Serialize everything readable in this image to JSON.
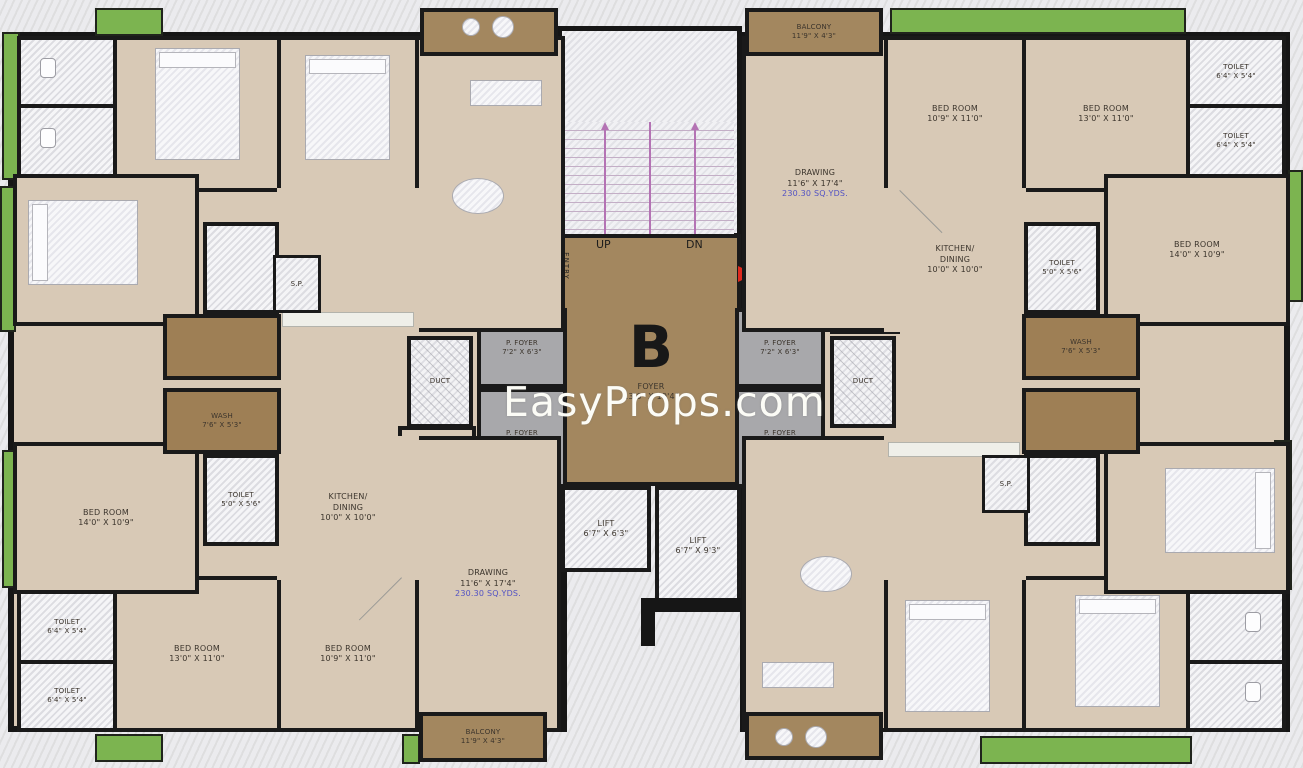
{
  "watermark": "EasyProps.com",
  "core": {
    "unit_letter": "B",
    "foyer": {
      "name": "FOYER",
      "dims": "13'6\" X 19'4\""
    },
    "up": "UP",
    "dn": "DN",
    "lift_left": {
      "name": "LIFT",
      "dims": "6'7\" X 6'3\""
    },
    "lift_right": {
      "name": "LIFT",
      "dims": "6'7\" X 9'3\""
    },
    "entries": {
      "e01": {
        "label": "ENTRY",
        "number": "01"
      },
      "e02": {
        "label": "ENTRY",
        "number": "02"
      },
      "e03": {
        "label": "ENTRY",
        "number": "03"
      },
      "e04": {
        "label": "ENTRY",
        "number": "04"
      }
    },
    "pfoyer_left_top": {
      "name": "P. FOYER",
      "dims": "7'2\" X 6'3\""
    },
    "pfoyer_left_bottom": {
      "name": "P. FOYER",
      "dims": "7'2\" X 7'8\""
    },
    "pfoyer_right_top": {
      "name": "P. FOYER",
      "dims": "7'2\" X 6'3\""
    },
    "pfoyer_right_bottom": {
      "name": "P. FOYER",
      "dims": "7'2\" X 7'8\""
    },
    "duct_left": "DUCT",
    "duct_right": "DUCT",
    "store_left": {
      "name": "STORE",
      "dims": "4'7\" X 4'0\""
    },
    "store_right": {
      "name": "STORE",
      "dims": "4'7\" X 4'0\""
    }
  },
  "unit01": {
    "balcony": {
      "name": "BALCONY",
      "dims": "11'9\" X 4'3\""
    },
    "drawing": {
      "name": "DRAWING",
      "dims": "11'6\" X 17'4\"",
      "area": "230.30 SQ.YDS."
    },
    "bedroom_a": {
      "name": "BED ROOM",
      "dims": "10'9\" X 11'0\""
    },
    "bedroom_b": {
      "name": "BED ROOM",
      "dims": "13'0\" X 11'0\""
    },
    "bedroom_c": {
      "name": "BED ROOM",
      "dims": "14'0\" X 10'9\""
    },
    "kitchen": {
      "line1": "KITCHEN/",
      "line2": "DINING",
      "dims": "10'0\" X 10'0\""
    },
    "toilet_a": {
      "name": "TOILET",
      "dims": "6'4\" X 5'4\""
    },
    "toilet_b": {
      "name": "TOILET",
      "dims": "6'4\" X 5'4\""
    },
    "toilet_c": {
      "name": "TOILET",
      "dims": "5'0\" X 5'6\""
    },
    "wash": {
      "name": "WASH",
      "dims": "7'6\" X 5'3\""
    }
  },
  "unit03": {
    "balcony": {
      "name": "BALCONY",
      "dims": "11'9\" X 4'3\""
    },
    "drawing": {
      "name": "DRAWING",
      "dims": "11'6\" X 17'4\"",
      "area": "230.30 SQ.YDS."
    },
    "bedroom_a": {
      "name": "BED ROOM",
      "dims": "10'9\" X 11'0\""
    },
    "bedroom_b": {
      "name": "BED ROOM",
      "dims": "13'0\" X 11'0\""
    },
    "bedroom_c": {
      "name": "BED ROOM",
      "dims": "14'0\" X 10'9\""
    },
    "kitchen": {
      "line1": "KITCHEN/",
      "line2": "DINING",
      "dims": "10'0\" X 10'0\""
    },
    "toilet_a": {
      "name": "TOILET",
      "dims": "6'4\" X 5'4\""
    },
    "toilet_b": {
      "name": "TOILET",
      "dims": "6'4\" X 5'4\""
    },
    "toilet_c": {
      "name": "TOILET",
      "dims": "5'0\" X 5'6\""
    },
    "wash": {
      "name": "WASH",
      "dims": "7'6\" X 5'3\""
    }
  },
  "unit02": {
    "sp": "S.P."
  },
  "unit04": {
    "sp": "S.P."
  }
}
